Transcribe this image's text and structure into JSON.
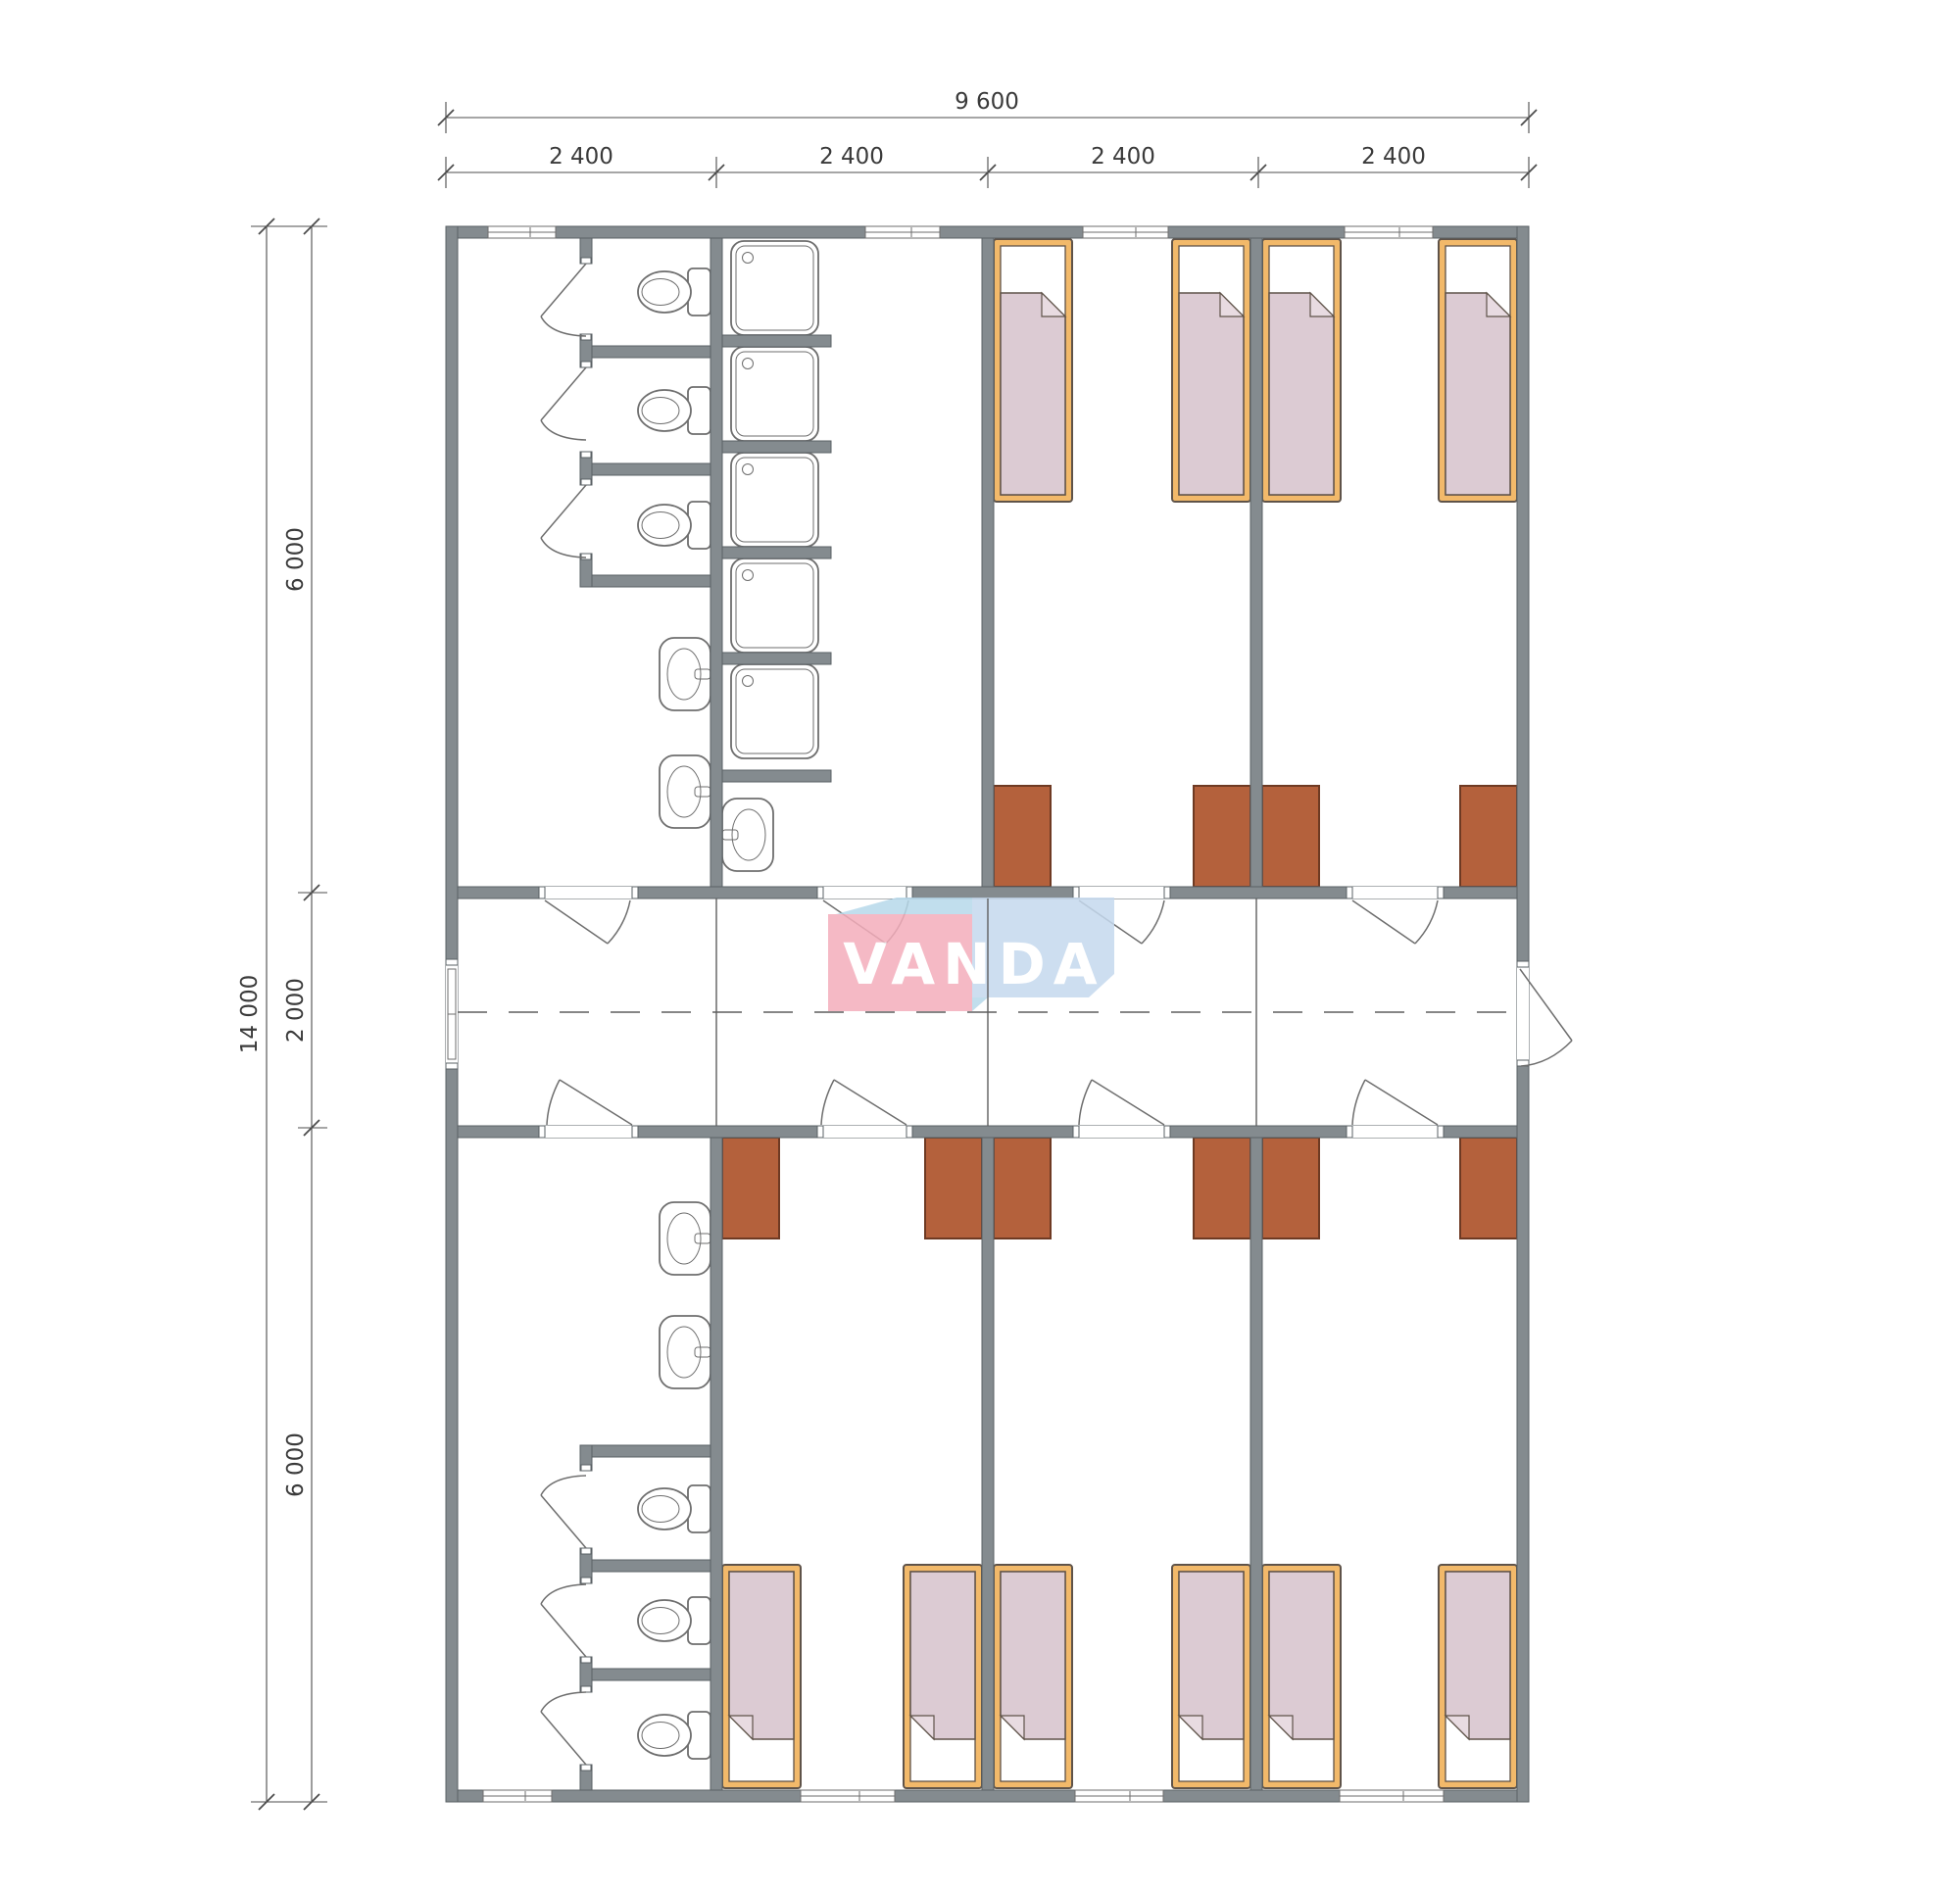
{
  "page": {
    "title": "Modular dormitory floor plan"
  },
  "logo": {
    "text": "VANDA",
    "colors": {
      "pink": "#f4adbb",
      "blue": "#c5d9ee",
      "band": "#b7d9ea",
      "text": "#ffffff"
    }
  },
  "dimensions": {
    "top_total": "9 600",
    "top_modules": [
      "2 400",
      "2 400",
      "2 400",
      "2 400"
    ],
    "left_total": "14 000",
    "left_sections": [
      "6 000",
      "2 000",
      "6 000"
    ]
  },
  "fixtures": {
    "beds": 10,
    "wardrobes": 10,
    "toilets": 6,
    "showers": 5,
    "sinks": 5,
    "room_doors": 8,
    "toilet_stall_doors": 6,
    "exterior_doors": 2,
    "windows": 8
  },
  "colors": {
    "wall": "#848b8f",
    "wall-stroke": "#5a6064",
    "line": "#6e6e6e",
    "bed-frame": "#f2b96a",
    "blanket": "#dccbd3",
    "fold": "#e8dbe1",
    "outline": "#5f5349",
    "wardrobe": "#b4613c",
    "wardrobe-stroke": "#6e3a23",
    "centerline": "#5f5f5f",
    "dim": "#4c4c4c",
    "dim-text": "#3a3a3a"
  }
}
